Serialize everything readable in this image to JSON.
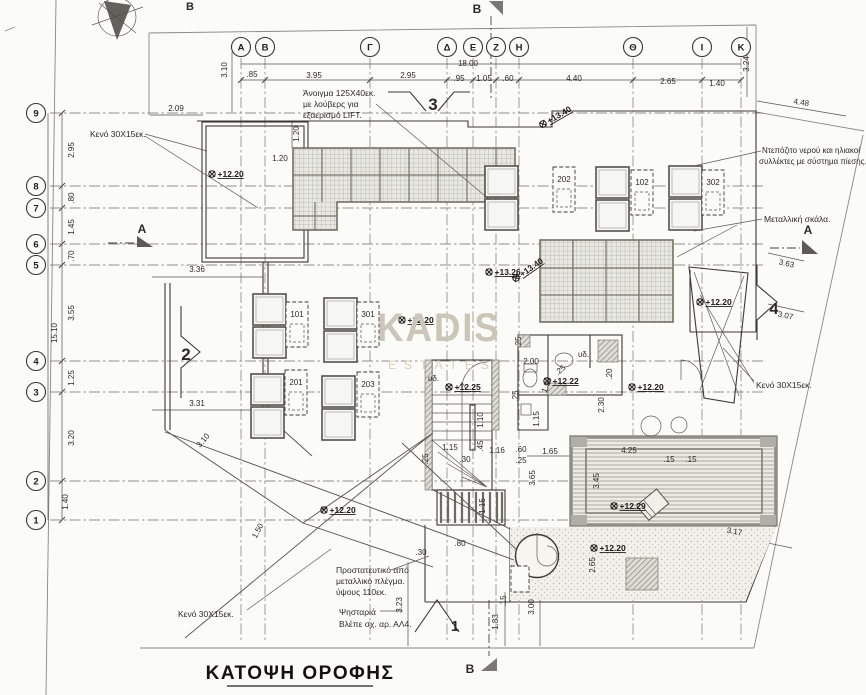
{
  "title": {
    "text": "ΚΑΤΟΨΗ ΟΡΟΦΗΣ"
  },
  "watermark": {
    "line1": "KADIS",
    "line2": "ESTATES"
  },
  "grid": {
    "columns": [
      {
        "label": "A",
        "x": 241
      },
      {
        "label": "B",
        "x": 265
      },
      {
        "label": "Γ",
        "x": 370
      },
      {
        "label": "Δ",
        "x": 447
      },
      {
        "label": "E",
        "x": 473
      },
      {
        "label": "Z",
        "x": 496
      },
      {
        "label": "H",
        "x": 519
      },
      {
        "label": "Θ",
        "x": 633
      },
      {
        "label": "I",
        "x": 702
      },
      {
        "label": "K",
        "x": 741
      }
    ],
    "rows": [
      {
        "label": "9",
        "y": 113
      },
      {
        "label": "8",
        "y": 186
      },
      {
        "label": "7",
        "y": 208
      },
      {
        "label": "6",
        "y": 244
      },
      {
        "label": "5",
        "y": 265
      },
      {
        "label": "4",
        "y": 361
      },
      {
        "label": "3",
        "y": 392
      },
      {
        "label": "2",
        "y": 481
      },
      {
        "label": "1",
        "y": 520
      }
    ]
  },
  "units": [
    {
      "label": "202",
      "box": [
        553,
        167
      ],
      "squares": [
        [
          485,
          166
        ],
        [
          485,
          199
        ]
      ]
    },
    {
      "label": "102",
      "box": [
        631,
        170
      ],
      "squares": [
        [
          596,
          167
        ],
        [
          596,
          200
        ]
      ]
    },
    {
      "label": "302",
      "box": [
        702,
        170
      ],
      "squares": [
        [
          669,
          166
        ],
        [
          669,
          199
        ]
      ]
    },
    {
      "label": "101",
      "box": [
        286,
        302
      ],
      "squares": [
        [
          253,
          294
        ],
        [
          253,
          327
        ]
      ]
    },
    {
      "label": "301",
      "box": [
        357,
        302
      ],
      "squares": [
        [
          324,
          298
        ],
        [
          324,
          331
        ]
      ]
    },
    {
      "label": "201",
      "box": [
        285,
        370
      ],
      "squares": [
        [
          251,
          374
        ],
        [
          251,
          407
        ]
      ]
    },
    {
      "label": "203",
      "box": [
        357,
        372
      ],
      "squares": [
        [
          322,
          376
        ],
        [
          322,
          409
        ]
      ]
    }
  ],
  "elevations": [
    {
      "v": "+12.20",
      "x": 212,
      "y": 174
    },
    {
      "v": "+12.20",
      "x": 402,
      "y": 320
    },
    {
      "v": "+13.26",
      "x": 489,
      "y": 272
    },
    {
      "v": "+13.40",
      "x": 516,
      "y": 278,
      "r": -35
    },
    {
      "v": "+13.40",
      "x": 543,
      "y": 124,
      "r": -30
    },
    {
      "v": "+12.20",
      "x": 700,
      "y": 302
    },
    {
      "v": "+12.22",
      "x": 547,
      "y": 381
    },
    {
      "v": "+12.25",
      "x": 449,
      "y": 387
    },
    {
      "v": "+12.20",
      "x": 632,
      "y": 387
    },
    {
      "v": "+12.20",
      "x": 324,
      "y": 510
    },
    {
      "v": "+12.29",
      "x": 614,
      "y": 506
    },
    {
      "v": "+12.20",
      "x": 594,
      "y": 548
    }
  ],
  "annotations": {
    "labels": [
      {
        "t": "18.00",
        "x": 468,
        "y": 66
      },
      {
        "t": ".85",
        "x": 252,
        "y": 77
      },
      {
        "t": "3.95",
        "x": 314,
        "y": 78
      },
      {
        "t": "2.95",
        "x": 408,
        "y": 78
      },
      {
        "t": ".95",
        "x": 459,
        "y": 81
      },
      {
        "t": "1.05",
        "x": 484,
        "y": 81
      },
      {
        "t": ".60",
        "x": 508,
        "y": 81
      },
      {
        "t": "4.40",
        "x": 574,
        "y": 81
      },
      {
        "t": "2.65",
        "x": 668,
        "y": 84
      },
      {
        "t": "1.40",
        "x": 717,
        "y": 86
      },
      {
        "t": "3.10",
        "x": 227,
        "y": 70,
        "r": -90
      },
      {
        "t": "3.24",
        "x": 749,
        "y": 64,
        "r": -90
      },
      {
        "t": "4.48",
        "x": 801,
        "y": 105,
        "r": 8
      },
      {
        "t": "2.09",
        "x": 176,
        "y": 111
      },
      {
        "t": "2.95",
        "x": 74,
        "y": 150,
        "r": -90
      },
      {
        "t": ".80",
        "x": 74,
        "y": 198,
        "r": -90
      },
      {
        "t": "1.45",
        "x": 74,
        "y": 227,
        "r": -90
      },
      {
        "t": ".70",
        "x": 74,
        "y": 256,
        "r": -90
      },
      {
        "t": "3.55",
        "x": 74,
        "y": 313,
        "r": -90
      },
      {
        "t": "15.10",
        "x": 57,
        "y": 333,
        "r": -90
      },
      {
        "t": "1.25",
        "x": 74,
        "y": 378,
        "r": -90
      },
      {
        "t": "3.20",
        "x": 74,
        "y": 438,
        "r": -90
      },
      {
        "t": "1.40",
        "x": 68,
        "y": 502,
        "r": -90
      },
      {
        "t": "1.20",
        "x": 299,
        "y": 134,
        "r": -90
      },
      {
        "t": "1.20",
        "x": 280,
        "y": 161
      },
      {
        "t": "3.36",
        "x": 197,
        "y": 272
      },
      {
        "t": "3.31",
        "x": 197,
        "y": 406
      },
      {
        "t": "3.10",
        "x": 205,
        "y": 442,
        "r": -50
      },
      {
        "t": "1.50",
        "x": 260,
        "y": 532,
        "r": -62
      },
      {
        "t": "2.00",
        "x": 531,
        "y": 364
      },
      {
        "t": ".25",
        "x": 521,
        "y": 342,
        "r": -90
      },
      {
        "t": ".25",
        "x": 562,
        "y": 372,
        "r": -40
      },
      {
        "t": "1.50",
        "x": 549,
        "y": 386,
        "r": -68
      },
      {
        "t": ".25",
        "x": 518,
        "y": 396,
        "r": -90
      },
      {
        "t": ".20",
        "x": 612,
        "y": 374,
        "r": -90
      },
      {
        "t": "2.30",
        "x": 604,
        "y": 405,
        "r": -90
      },
      {
        "t": "1.15",
        "x": 539,
        "y": 419,
        "r": -90
      },
      {
        "t": "1.65",
        "x": 550,
        "y": 454
      },
      {
        "t": "4.25",
        "x": 629,
        "y": 453
      },
      {
        "t": ".60",
        "x": 521,
        "y": 452
      },
      {
        "t": ".25",
        "x": 521,
        "y": 463
      },
      {
        "t": "1.16",
        "x": 497,
        "y": 453
      },
      {
        "t": ".30",
        "x": 465,
        "y": 462
      },
      {
        "t": "1.15",
        "x": 450,
        "y": 450
      },
      {
        "t": "1.10",
        "x": 483,
        "y": 420,
        "r": -90
      },
      {
        "t": ".45",
        "x": 483,
        "y": 446,
        "r": -90
      },
      {
        "t": ".25",
        "x": 428,
        "y": 459,
        "r": -90
      },
      {
        "t": "1.15",
        "x": 485,
        "y": 506,
        "r": -90
      },
      {
        "t": "3.65",
        "x": 535,
        "y": 478,
        "r": -90
      },
      {
        "t": "3.45",
        "x": 599,
        "y": 481,
        "r": -90
      },
      {
        "t": "3.17",
        "x": 734,
        "y": 534,
        "r": 10
      },
      {
        "t": "2.65",
        "x": 595,
        "y": 565,
        "r": -90
      },
      {
        "t": "3.00",
        "x": 534,
        "y": 607,
        "r": -90
      },
      {
        "t": "1.83",
        "x": 498,
        "y": 622,
        "r": -90
      },
      {
        "t": "3.23",
        "x": 402,
        "y": 605,
        "r": -90
      },
      {
        "t": ".15",
        "x": 506,
        "y": 601,
        "r": -90
      },
      {
        "t": ".30",
        "x": 421,
        "y": 555
      },
      {
        "t": ".80",
        "x": 460,
        "y": 546
      },
      {
        "t": ".15",
        "x": 669,
        "y": 462
      },
      {
        "t": ".15",
        "x": 691,
        "y": 462
      },
      {
        "t": "3.63",
        "x": 786,
        "y": 266,
        "r": 12
      },
      {
        "t": "3.07",
        "x": 785,
        "y": 318,
        "r": 12
      },
      {
        "t": "υδ.",
        "x": 428,
        "y": 381,
        "a": "start",
        "n": "plumbing-label"
      },
      {
        "t": "υδ.",
        "x": 578,
        "y": 357,
        "a": "start",
        "n": "plumbing-label"
      },
      {
        "t": "Κενό 30X15εκ.",
        "x": 90,
        "y": 137,
        "a": "start",
        "s": 8.5,
        "n": "note-text"
      },
      {
        "t": "Άνοιγμα 125X40εκ.",
        "x": 303,
        "y": 96,
        "a": "start",
        "s": 8.5,
        "n": "note-text"
      },
      {
        "t": "με λούβερς για",
        "x": 303,
        "y": 107,
        "a": "start",
        "s": 8.5,
        "n": "note-text"
      },
      {
        "t": "εξαερισμό LIFT.",
        "x": 303,
        "y": 118,
        "a": "start",
        "s": 8.5,
        "n": "note-text"
      },
      {
        "t": "Ντεπόζιτο νερού και ηλιακοί",
        "x": 762,
        "y": 153,
        "a": "start",
        "s": 8,
        "n": "note-text"
      },
      {
        "t": "συλλέκτες με σύστημα πίεσης.",
        "x": 759,
        "y": 164,
        "a": "start",
        "s": 8,
        "n": "note-text"
      },
      {
        "t": "Μεταλλική σκάλα.",
        "x": 764,
        "y": 222,
        "a": "start",
        "s": 8.5,
        "n": "note-text"
      },
      {
        "t": "Κενό 30X15εκ.",
        "x": 756,
        "y": 388,
        "a": "start",
        "s": 8.5,
        "n": "note-text"
      },
      {
        "t": "Προστατευτικό από",
        "x": 336,
        "y": 573,
        "a": "start",
        "s": 8.5,
        "n": "note-text"
      },
      {
        "t": "μεταλλικό πλέγμα.",
        "x": 336,
        "y": 584,
        "a": "start",
        "s": 8.5,
        "n": "note-text"
      },
      {
        "t": "ύψους 110εκ.",
        "x": 336,
        "y": 595,
        "a": "start",
        "s": 8.5,
        "n": "note-text"
      },
      {
        "t": "Ψησταριά",
        "x": 339,
        "y": 615,
        "a": "start",
        "s": 8.5,
        "n": "note-text"
      },
      {
        "t": "Βλέπε σχ. αρ. ΑΛ4.",
        "x": 339,
        "y": 627,
        "a": "start",
        "s": 8.5,
        "n": "note-text"
      },
      {
        "t": "Κενό 30X15εκ.",
        "x": 178,
        "y": 617,
        "a": "start",
        "s": 8.5,
        "n": "note-text"
      },
      {
        "t": "3",
        "x": 433,
        "y": 110,
        "s": 17,
        "b": 1,
        "n": "detail-number"
      },
      {
        "t": "2",
        "x": 186,
        "y": 360,
        "s": 17,
        "b": 1,
        "n": "detail-number"
      },
      {
        "t": "4",
        "x": 774,
        "y": 314,
        "s": 16,
        "b": 1,
        "n": "detail-number"
      },
      {
        "t": "1",
        "x": 455,
        "y": 631,
        "s": 15,
        "b": 1,
        "n": "detail-number"
      },
      {
        "t": "A",
        "x": 142,
        "y": 233,
        "s": 12,
        "b": 1,
        "n": "section-letter"
      },
      {
        "t": "A",
        "x": 808,
        "y": 234,
        "s": 12,
        "b": 1,
        "n": "section-letter"
      },
      {
        "t": "B",
        "x": 477,
        "y": 13,
        "s": 12,
        "b": 1,
        "n": "section-letter"
      },
      {
        "t": "B",
        "x": 470,
        "y": 673,
        "s": 12,
        "b": 1,
        "n": "section-letter"
      },
      {
        "t": "B",
        "x": 190,
        "y": 10,
        "s": 11,
        "b": 1,
        "n": "section-letter"
      }
    ]
  }
}
